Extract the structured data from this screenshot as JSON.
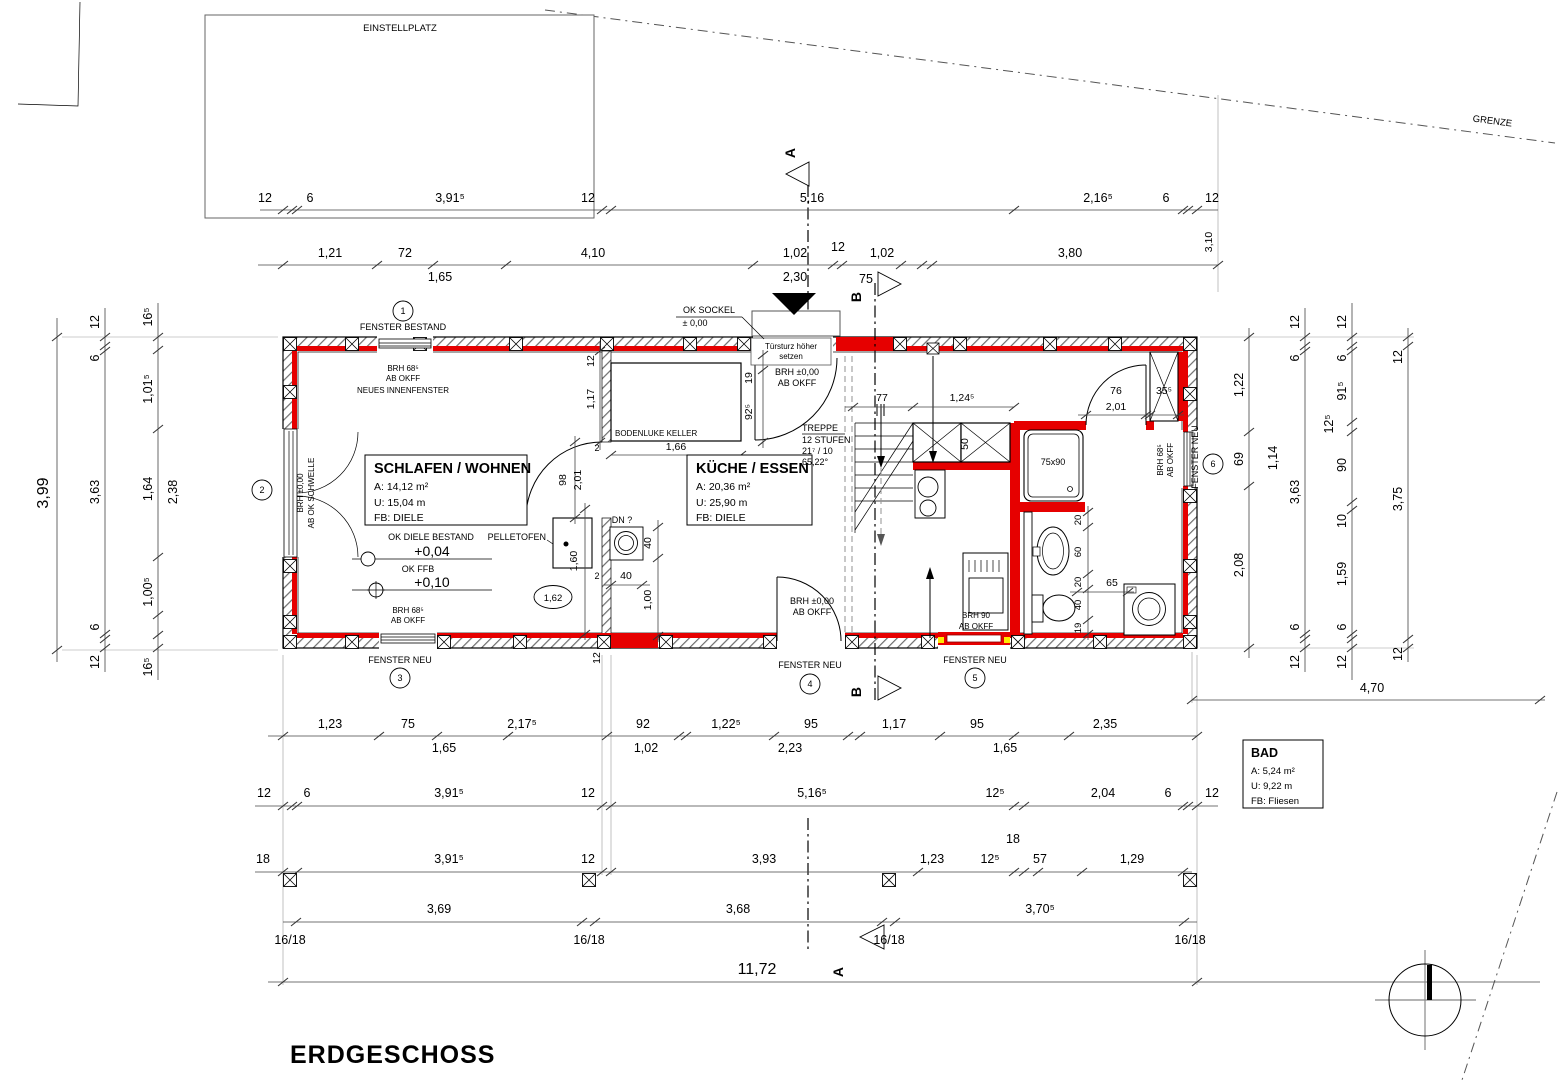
{
  "title": "ERDGESCHOSS",
  "site": {
    "einstellplatz": "EINSTELLPLATZ",
    "grenze": "GRENZE"
  },
  "sections": {
    "a": "A",
    "b": "B"
  },
  "rooms": {
    "schlafen": {
      "name": "SCHLAFEN / WOHNEN",
      "a": "A: 14,12 m²",
      "u": "U: 15,04 m",
      "fb": "FB: DIELE"
    },
    "kueche": {
      "name": "KÜCHE / ESSEN",
      "a": "A: 20,36 m²",
      "u": "U: 25,90 m",
      "fb": "FB: DIELE"
    },
    "bad": {
      "name": "BAD",
      "a": "A: 5,24 m²",
      "u": "U: 9,22 m",
      "fb": "FB: Fliesen"
    }
  },
  "treppe": {
    "t1": "TREPPE",
    "t2": "12 STUFEN",
    "t3": "21⁷ / 10",
    "t4": "65,22°"
  },
  "ann": {
    "fenster_bestand": "FENSTER BESTAND",
    "fenster_neu": "FENSTER NEU",
    "n1": "1",
    "n2": "2",
    "n3": "3",
    "n4": "4",
    "n5": "5",
    "n6": "6",
    "brh685": "BRH 68⁵",
    "ab_okff": "AB OKFF",
    "neu_innen": "NEUES INNENFENSTER",
    "brh000": "BRH ±0,00",
    "ab_schwelle": "AB OK SCHWELLE",
    "ok_diele": "OK DIELE BESTAND",
    "p004": "+0,04",
    "ok_ffb": "OK FFB",
    "p010": "+0,10",
    "ok_sockel": "OK SOCKEL",
    "pm": "± 0,00",
    "tuer1": "Türsturz höher",
    "tuer2": "setzen",
    "pellet": "PELLETOFEN",
    "luke": "BODENLUKE KELLER",
    "dn": "DN ?",
    "brh90": "BRH 90",
    "shower": "75x90"
  },
  "dims": {
    "t1": [
      "12",
      "6",
      "3,91⁵",
      "12",
      "5,16",
      "2,16⁵",
      "6",
      "12"
    ],
    "t1v": "3,10",
    "t2": [
      "1,21",
      "72",
      "4,10",
      "1,02",
      "12",
      "1,02",
      "3,80"
    ],
    "t2s": [
      "1,65",
      "2,30",
      "75"
    ],
    "l1": "3,99",
    "l2": [
      "12",
      "6",
      "3,63",
      "6",
      "12"
    ],
    "l3": [
      "16⁵",
      "1,01⁵",
      "1,64",
      "2,38",
      "1,00⁵",
      "16⁵"
    ],
    "r1": [
      "1,22",
      "69",
      "2,08"
    ],
    "r1b": "1,14",
    "r2": [
      "12",
      "6",
      "3,63",
      "6",
      "12"
    ],
    "r3": [
      "12",
      "6",
      "91⁵",
      "12⁵",
      "90",
      "10",
      "1,59",
      "6",
      "12"
    ],
    "r4": [
      "12",
      "3,75",
      "12"
    ],
    "r5": "4,70",
    "b1": [
      "1,23",
      "75",
      "2,17⁵",
      "92",
      "1,22⁵",
      "95",
      "1,17",
      "95",
      "2,35"
    ],
    "b1s": [
      "1,65",
      "1,02",
      "2,23",
      "1,65"
    ],
    "b2": [
      "12",
      "6",
      "3,91⁵",
      "12",
      "5,16⁵",
      "12⁵",
      "2,04",
      "6",
      "12"
    ],
    "b3": [
      "18",
      "3,91⁵",
      "12",
      "3,93",
      "1,23",
      "12⁵",
      "18",
      "57",
      "1,29"
    ],
    "b4": [
      "3,69",
      "3,68",
      "3,70⁵"
    ],
    "post": "16/18",
    "total": "11,72",
    "stair": [
      "77",
      "1,24⁵",
      "50"
    ],
    "entry": [
      "19",
      "92⁵"
    ],
    "idoor": [
      "98",
      "2,01"
    ],
    "iwall": [
      "12",
      "1,17",
      "12"
    ],
    "luke": "1,66",
    "pellet": "1,60",
    "pellet2": "1,62",
    "two": "2",
    "drain": [
      "40",
      "40",
      "1,00"
    ],
    "bath": [
      "20",
      "60",
      "20",
      "40",
      "19"
    ],
    "bath65": "65",
    "bdoor": [
      "76",
      "2,01",
      "35⁵"
    ]
  }
}
